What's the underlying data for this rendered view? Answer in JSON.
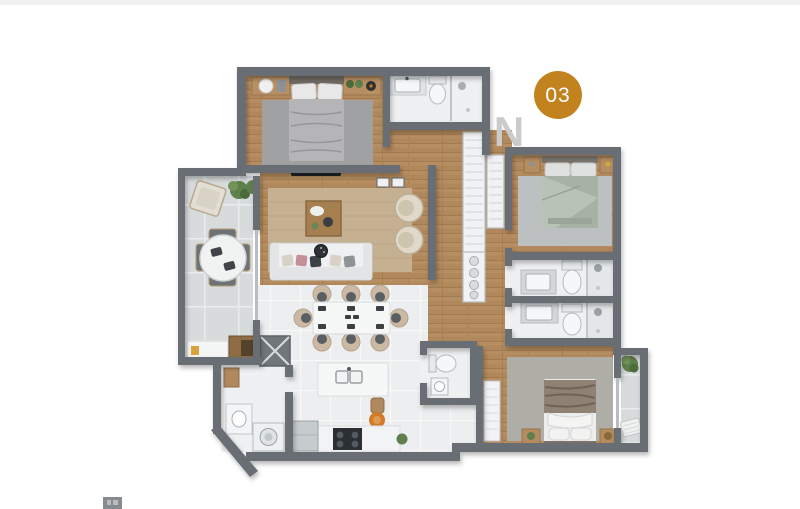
{
  "figure": {
    "type": "apartment-floor-plan"
  },
  "badge": {
    "label": "03",
    "circle_color": "#c2831e",
    "text_color": "#ffffff"
  },
  "watermark": {
    "letter": "N",
    "color": "#c9cbcd"
  },
  "palette": {
    "wall": "#696e74",
    "wood_floor": "#b1885c",
    "balcony_tile": "#d7dbdc",
    "white_floor": "#eceeef",
    "rug_master": "#9fa1a3",
    "rug_bedroom2": "#bdc0c1",
    "rug_bedroom3": "#aeaea6",
    "rug_living": "#c6b092",
    "bed_sage": "#a7b2a5",
    "accent_gold": "#c2831e",
    "greenery": "#5f7f4c",
    "appliance_dark": "#2b2f33"
  }
}
